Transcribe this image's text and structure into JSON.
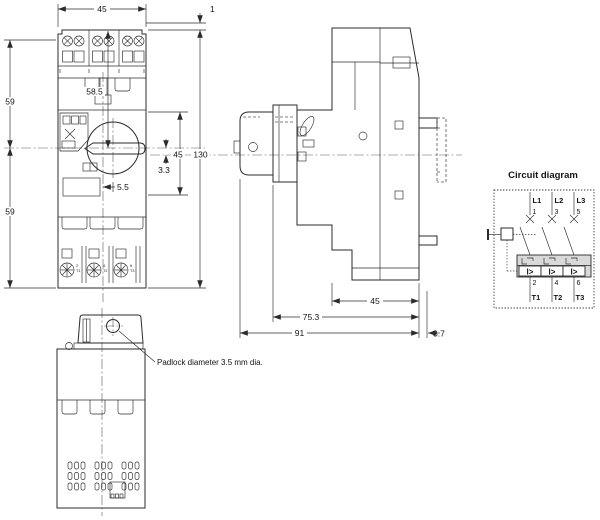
{
  "front_view": {
    "dim_width_top": "45",
    "dim_offset_top": "1",
    "dim_58_5": "58.5",
    "dim_59_upper": "59",
    "dim_59_lower": "59",
    "dim_45_right": "45",
    "dim_130": "130",
    "dim_3_3": "3.3",
    "dim_5_5": "5.5",
    "terminal_labels_bottom": [
      [
        "2",
        "T1"
      ],
      [
        "4",
        "T2"
      ],
      [
        "6",
        "T3"
      ]
    ]
  },
  "side_view": {
    "dim_45": "45",
    "dim_75_3": "75.3",
    "dim_91": "91",
    "dim_3_7": "3.7"
  },
  "bottom_view": {
    "padlock_note": "Padlock diameter 3.5 mm dia."
  },
  "circuit_diagram": {
    "title": "Circuit diagram",
    "trip_symbol": "I>",
    "poles": [
      {
        "line": "L1",
        "in": "1",
        "out": "2",
        "t": "T1",
        "trip": "I>"
      },
      {
        "line": "L2",
        "in": "3",
        "out": "4",
        "t": "T2",
        "trip": "I>"
      },
      {
        "line": "L3",
        "in": "5",
        "out": "6",
        "t": "T3",
        "trip": "I>"
      }
    ]
  },
  "colors": {
    "line": "#2b2b2b",
    "centerline": "#5a5a5a",
    "trip_fill": "#d9d9d9"
  }
}
